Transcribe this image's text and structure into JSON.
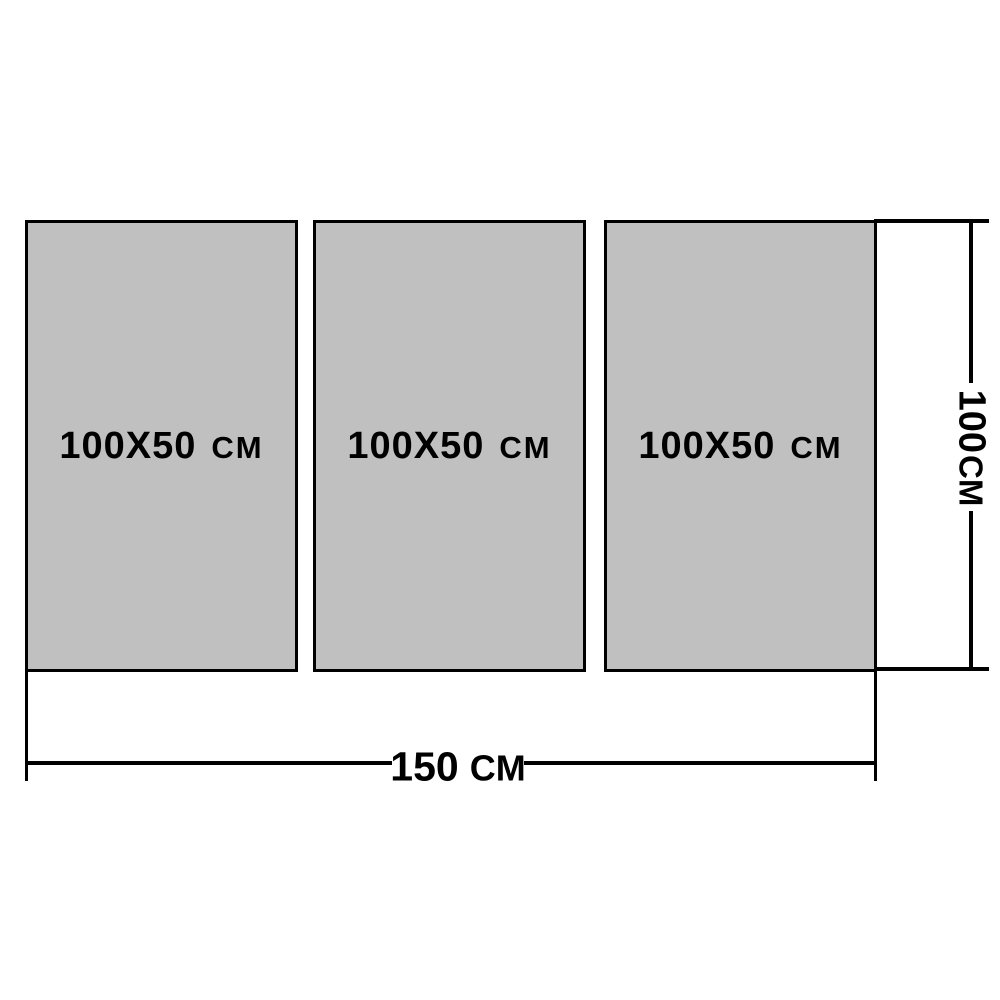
{
  "colors": {
    "background": "#ffffff",
    "panel_fill": "#c0c0c0",
    "line": "#000000",
    "text": "#000000"
  },
  "panels": [
    {
      "size": "100X50",
      "unit": "CM"
    },
    {
      "size": "100X50",
      "unit": "CM"
    },
    {
      "size": "100X50",
      "unit": "CM"
    }
  ],
  "dimensions": {
    "total_width": {
      "value": "150",
      "unit": "CM"
    },
    "total_height": {
      "value": "100",
      "unit": "CM"
    }
  }
}
